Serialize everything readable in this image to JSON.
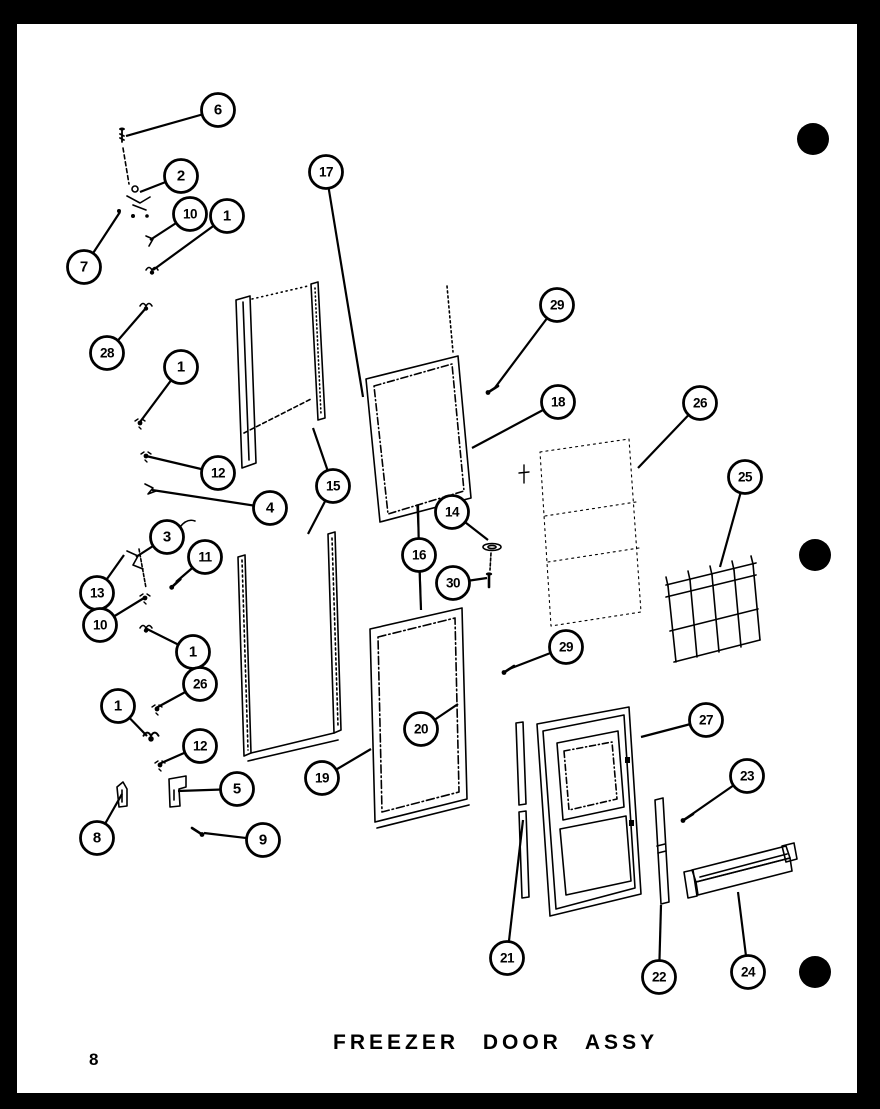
{
  "page": {
    "number": "8",
    "title": "FREEZER DOOR ASSY"
  },
  "colors": {
    "ink": "#000000",
    "paper": "#ffffff"
  },
  "binder_holes": [
    {
      "cx": 813,
      "cy": 139,
      "r": 16
    },
    {
      "cx": 815,
      "cy": 555,
      "r": 16
    },
    {
      "cx": 815,
      "cy": 972,
      "r": 16
    }
  ],
  "callouts": [
    {
      "label": "6",
      "cx": 218,
      "cy": 110,
      "targets": [
        [
          126,
          136
        ]
      ]
    },
    {
      "label": "2",
      "cx": 181,
      "cy": 176,
      "targets": [
        [
          140,
          192
        ]
      ]
    },
    {
      "label": "10",
      "cx": 190,
      "cy": 214,
      "targets": [
        [
          150,
          240
        ]
      ]
    },
    {
      "label": "1",
      "cx": 227,
      "cy": 216,
      "targets": [
        [
          153,
          270
        ]
      ]
    },
    {
      "label": "7",
      "cx": 84,
      "cy": 267,
      "targets": [
        [
          120,
          212
        ]
      ]
    },
    {
      "label": "28",
      "cx": 107,
      "cy": 353,
      "targets": [
        [
          146,
          308
        ]
      ]
    },
    {
      "label": "17",
      "cx": 326,
      "cy": 172,
      "targets": [
        [
          363,
          397
        ]
      ]
    },
    {
      "label": "29",
      "cx": 557,
      "cy": 305,
      "targets": [
        [
          494,
          389
        ]
      ]
    },
    {
      "label": "18",
      "cx": 558,
      "cy": 402,
      "targets": [
        [
          472,
          448
        ]
      ]
    },
    {
      "label": "26",
      "cx": 700,
      "cy": 403,
      "targets": [
        [
          638,
          468
        ]
      ]
    },
    {
      "label": "25",
      "cx": 745,
      "cy": 477,
      "targets": [
        [
          720,
          567
        ]
      ]
    },
    {
      "label": "1",
      "cx": 181,
      "cy": 367,
      "targets": [
        [
          140,
          422
        ]
      ]
    },
    {
      "label": "12",
      "cx": 218,
      "cy": 473,
      "targets": [
        [
          146,
          456
        ]
      ]
    },
    {
      "label": "4",
      "cx": 270,
      "cy": 508,
      "targets": [
        [
          152,
          490
        ]
      ]
    },
    {
      "label": "15",
      "cx": 333,
      "cy": 486,
      "targets": [
        [
          313,
          428
        ],
        [
          308,
          534
        ]
      ]
    },
    {
      "label": "3",
      "cx": 167,
      "cy": 537,
      "targets": [
        [
          136,
          557
        ]
      ]
    },
    {
      "label": "11",
      "cx": 205,
      "cy": 557,
      "targets": [
        [
          176,
          582
        ]
      ]
    },
    {
      "label": "13",
      "cx": 97,
      "cy": 593,
      "targets": [
        [
          124,
          555
        ]
      ]
    },
    {
      "label": "10",
      "cx": 100,
      "cy": 625,
      "targets": [
        [
          144,
          598
        ]
      ]
    },
    {
      "label": "1",
      "cx": 193,
      "cy": 652,
      "targets": [
        [
          145,
          628
        ]
      ]
    },
    {
      "label": "26",
      "cx": 200,
      "cy": 684,
      "targets": [
        [
          156,
          708
        ]
      ]
    },
    {
      "label": "1",
      "cx": 118,
      "cy": 706,
      "targets": [
        [
          147,
          736
        ]
      ]
    },
    {
      "label": "12",
      "cx": 200,
      "cy": 746,
      "targets": [
        [
          159,
          764
        ]
      ]
    },
    {
      "label": "5",
      "cx": 237,
      "cy": 789,
      "targets": [
        [
          178,
          791
        ]
      ]
    },
    {
      "label": "8",
      "cx": 97,
      "cy": 838,
      "targets": [
        [
          122,
          794
        ]
      ]
    },
    {
      "label": "9",
      "cx": 263,
      "cy": 840,
      "targets": [
        [
          204,
          833
        ]
      ]
    },
    {
      "label": "19",
      "cx": 322,
      "cy": 778,
      "targets": [
        [
          371,
          749
        ]
      ]
    },
    {
      "label": "20",
      "cx": 421,
      "cy": 729,
      "targets": [
        [
          458,
          704
        ]
      ]
    },
    {
      "label": "29",
      "cx": 566,
      "cy": 647,
      "targets": [
        [
          509,
          669
        ]
      ]
    },
    {
      "label": "27",
      "cx": 706,
      "cy": 720,
      "targets": [
        [
          641,
          737
        ]
      ]
    },
    {
      "label": "23",
      "cx": 747,
      "cy": 776,
      "targets": [
        [
          688,
          817
        ]
      ]
    },
    {
      "label": "21",
      "cx": 507,
      "cy": 958,
      "targets": [
        [
          523,
          820
        ]
      ]
    },
    {
      "label": "22",
      "cx": 659,
      "cy": 977,
      "targets": [
        [
          661,
          905
        ]
      ]
    },
    {
      "label": "24",
      "cx": 748,
      "cy": 972,
      "targets": [
        [
          738,
          892
        ]
      ]
    },
    {
      "label": "14",
      "cx": 452,
      "cy": 512,
      "targets": [
        [
          488,
          540
        ]
      ]
    },
    {
      "label": "16",
      "cx": 419,
      "cy": 555,
      "targets": [
        [
          418,
          505
        ],
        [
          421,
          610
        ]
      ]
    },
    {
      "label": "30",
      "cx": 453,
      "cy": 583,
      "targets": [
        [
          487,
          578
        ]
      ]
    }
  ]
}
